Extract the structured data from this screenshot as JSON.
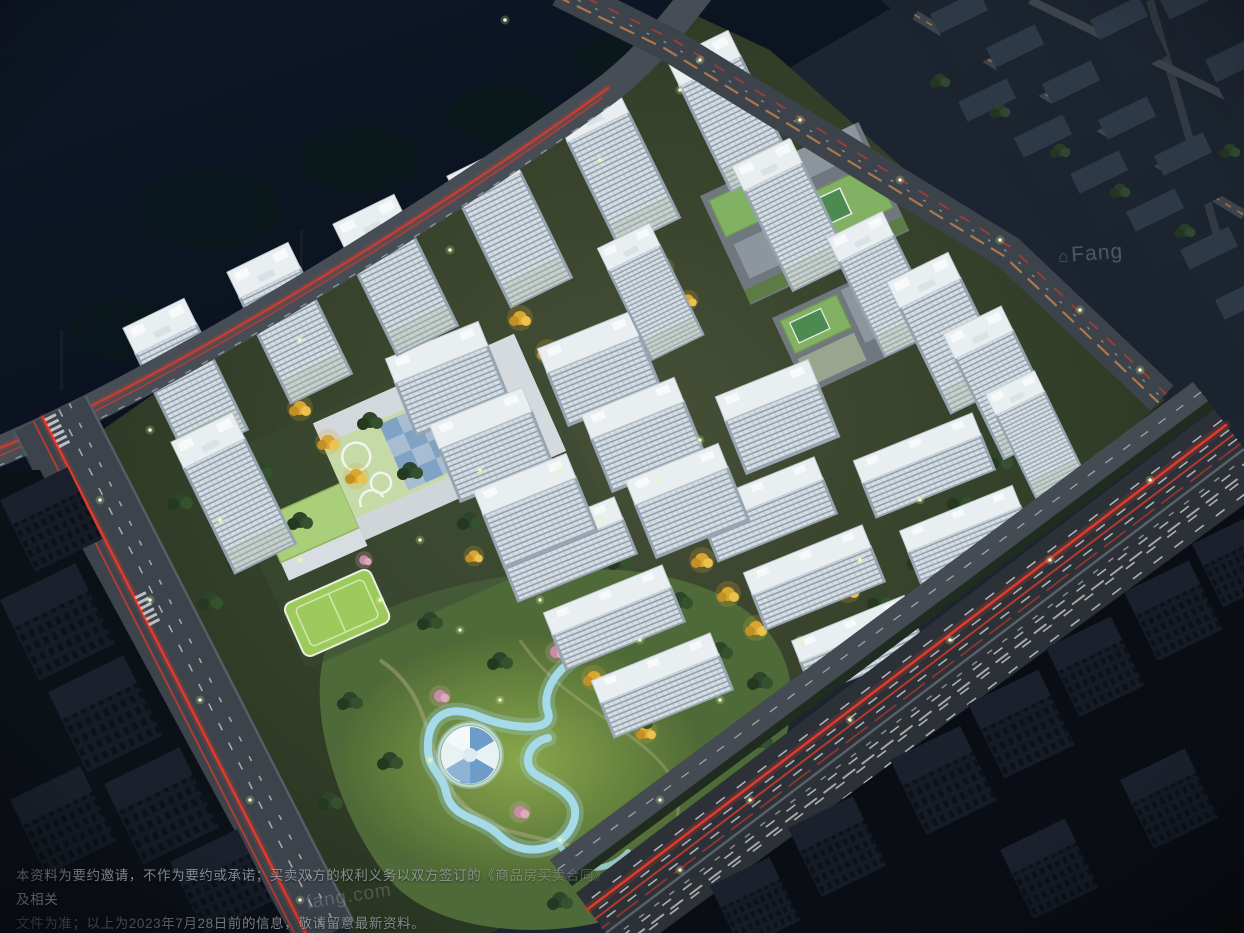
{
  "disclaimer": {
    "line1": "本资料为要约邀请，不作为要约或承诺；买卖双方的权利义务以双方签订的《商品房买卖合同》及相关",
    "line2": "文件为准；以上为2023年7月28日前的信息，敬请留意最新资料。"
  },
  "watermark": {
    "brand": "Fang",
    "house_glyph": "⌂",
    "url": "fang.com"
  },
  "colors": {
    "water": "#0c1522",
    "ground": "#1b2430",
    "compound_ground": "#26331f",
    "park_lawn": "#4e6a38",
    "park_lawn_lit": "#7d9a47",
    "road": "#3c434b",
    "road_light": "#474d55",
    "highway": "#2c3138",
    "lane_mark": "#d8dde2",
    "taillight": "#df3a2c",
    "headlight": "#efe7d2",
    "amber": "#d08a4b",
    "facade": "#d6dde3",
    "facade_side": "#95a3b0",
    "roof": "#e9eef1",
    "context_roof": "#2e3947",
    "context_side": "#1c2430",
    "dark_bldg": "#141b24",
    "tree": "#2c452b",
    "gold": "#ddab34",
    "pink": "#d093ab",
    "stream": "#a5dbe8",
    "school_roof": "#c3d9a2",
    "court_blue": "#7fa3c4",
    "field_green": "#8fc24b",
    "amenity_roof": "#83b164",
    "lamp": "#eef7c2",
    "text": "#9aa2a8",
    "watermark": "#dfe7ec"
  }
}
